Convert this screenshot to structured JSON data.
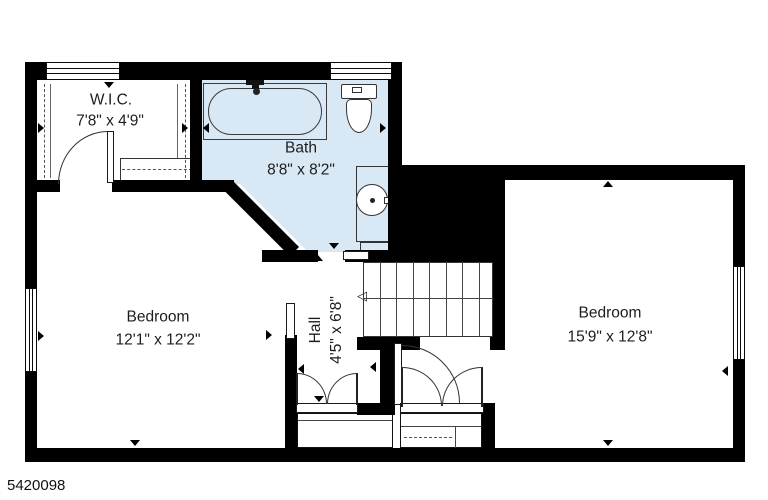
{
  "plan": {
    "listing_id": "5420098",
    "rooms": {
      "wic": {
        "name": "W.I.C.",
        "dims": "7'8\" x 4'9\""
      },
      "bath": {
        "name": "Bath",
        "dims": "8'8\" x 8'2\""
      },
      "hall": {
        "name": "Hall",
        "dims": "4'5\" x 6'8\""
      },
      "bedroom_left": {
        "name": "Bedroom",
        "dims": "12'1\" x 12'2\""
      },
      "bedroom_right": {
        "name": "Bedroom",
        "dims": "15'9\" x 12'8\""
      }
    },
    "stairs": {
      "direction_arrow": "◁"
    },
    "colors": {
      "wall": "#000000",
      "bath_fill": "#d9e8f5",
      "background": "#ffffff"
    }
  }
}
